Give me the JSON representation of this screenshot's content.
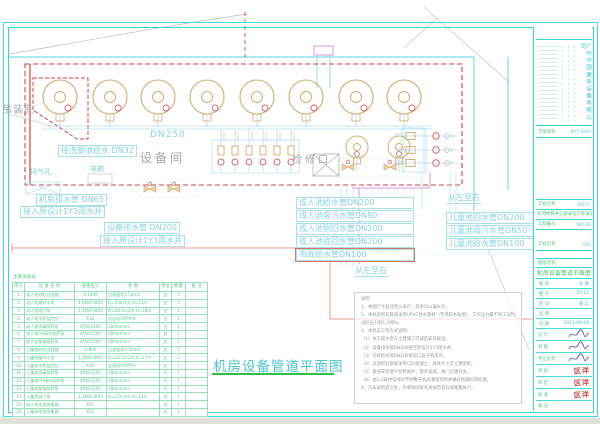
{
  "main_title": "机房设备管道平面图",
  "colors": {
    "frame_cyan": "#2fd6d6",
    "label_cyan": "#86d2e2",
    "table_green": "#5ac88d",
    "tank_tan": "#d4ab6e",
    "boundary_red": "#cc4444",
    "stamp_red": "#c84238",
    "underline_green": "#2ec043",
    "magenta_pipe": "#dd7ad8"
  },
  "plan": {
    "room_label": "设备间",
    "access_label": "检修口",
    "hoist_label": "吊装孔",
    "vent_label": "排气孔",
    "panel_label": "电箱",
    "washfoot_label": "接洗脚池给水 DN32",
    "main_pipe_label": "DN250",
    "direction_labels": [
      "从左至右",
      "从左至右"
    ],
    "drain_labels": [
      "机房排水管 DN65",
      "接入原设计1Y3雨水井",
      "设备排水管 DN200",
      "接入原设计1Y3雨水井"
    ],
    "adult_pipe_labels": [
      "成人池给水管DN200",
      "成人池吸污水管DN80",
      "成人池侧回水管DN200",
      "成人池底回水管DN200",
      "市政给水管DN100"
    ],
    "child_pipe_labels": [
      "儿童池回水管DN200",
      "儿童池吸污水管DN50",
      "儿童池给水管DN100"
    ],
    "tanks_large": {
      "cy": 97,
      "r": 17,
      "xs": [
        60,
        110,
        158,
        207,
        257,
        306,
        356,
        404
      ]
    },
    "tanks_small": {
      "cy": 147,
      "r": 11,
      "xs": [
        357,
        399
      ]
    },
    "manifold_vertical_xs": [
      221,
      235,
      249,
      263,
      277,
      291
    ],
    "manifold_horizontal_ys": [
      136,
      150,
      163
    ]
  },
  "equipment_table": {
    "caption": "主要设备表",
    "headers": [
      "序号",
      "设 备 名 称",
      "规格型号",
      "参  数",
      "单位",
      "数量",
      "备 注"
    ],
    "rows": [
      [
        "1",
        "成人池砂缸过滤器",
        "S-1400",
        "过滤面积1.54m2",
        "台",
        "5",
        ""
      ],
      [
        "2",
        "成人池循环水泵",
        "4.6KW/380V",
        "Q=50m3/h,H=23m",
        "台",
        "5",
        ""
      ],
      [
        "3",
        "成人池吸污泵",
        "2.2KW/380V",
        "Q=28.3m3/h,H=18m",
        "台",
        "1",
        ""
      ],
      [
        "4",
        "成人池水质监控仪",
        "K42",
        "全自动ORP/PH",
        "台",
        "1",
        ""
      ],
      [
        "5",
        "成人池消毒投药泵",
        "45W/220V",
        "280ml/min",
        "台",
        "1",
        ""
      ],
      [
        "6",
        "成人池PH调节投药泵",
        "45W/220V",
        "280ml/min",
        "台",
        "1",
        ""
      ],
      [
        "7",
        "成人池絮凝投药泵",
        "45W/220V",
        "280ml/min",
        "台",
        "1",
        ""
      ],
      [
        "8",
        "儿童池砂缸过滤器",
        "S-800",
        "过滤面积0.50m2",
        "台",
        "2",
        ""
      ],
      [
        "9",
        "儿童池循环水泵",
        "2.2KW/380V",
        "Q=28.5m3/h,H=17m",
        "台",
        "2",
        ""
      ],
      [
        "10",
        "儿童池水质监控仪",
        "K42",
        "全自动ORP/PH",
        "台",
        "1",
        ""
      ],
      [
        "11",
        "儿童池消毒投药泵",
        "45W/220V",
        "280ml/min",
        "台",
        "1",
        ""
      ],
      [
        "12",
        "儿童池PH调节投药泵",
        "45W/220V",
        "280ml/min",
        "台",
        "1",
        ""
      ],
      [
        "13",
        "儿童池絮凝投药泵",
        "45W/220V",
        "280ml/min",
        "台",
        "1",
        ""
      ],
      [
        "14",
        "儿童池吸污泵",
        "2.2KW/380V",
        "Q=15m3/h,H=13m",
        "台",
        "1",
        ""
      ],
      [
        "15",
        "成人池毛发收集器",
        "KT1",
        "",
        "台",
        "1",
        ""
      ],
      [
        "16",
        "儿童池毛发收集器",
        "KT2",
        "",
        "台",
        "1",
        ""
      ]
    ]
  },
  "notes": {
    "lines": [
      "说明",
      "1、本图尺寸标注皆以米计，其余均以毫米计。",
      "2、本机房所有管道采用UPVC给水管材（专用胶水粘接），工作压力最不利工况时，",
      "      试验压力取1.2MPa。",
      "3、本机房工作方式说明：",
      "   （1）本工程水泵在土建施工完成后安装就位。",
      "   （2）设备排水管DN200接至原设计1Y3雨水井。",
      "   （3）市政给水管DN100接驳口设于机房内。",
      "   （4）过滤砂缸基础采用C20混凝土，具体大小见土建图纸。",
      "   （5）管道安装便于检修维护，整齐美观，阀门方便开关。",
      "   （6）由1.2级材电线均不明敷于机房潮湿场所并做好防腐防锈处理。",
      "4、凡未说明者之处，均参照国家有关规范及标准图集执行。"
    ]
  },
  "titleblock": {
    "company": "广州中国康体设备有限公司",
    "cert": {
      "label": "节能审批",
      "value": "407-1049"
    },
    "project": {
      "label": "工程名称",
      "value": "PA127"
    },
    "project_name": "天河体育中心游泳馆户外泳池工程",
    "project_no": {
      "label": "工程编号",
      "value": "NST30"
    },
    "lead": {
      "label": "工程负责",
      "value": "02K"
    },
    "sheet": {
      "label": "图纸名称",
      "value": ""
    },
    "sheet_name": "机房设备管道平面图",
    "info_rows": [
      [
        "图 别",
        "水 施"
      ],
      [
        "图 号",
        "ZY-12"
      ],
      [
        "阶 段",
        "施 工"
      ],
      [
        "比 例",
        ""
      ],
      [
        "日 期",
        "2013-09-06"
      ]
    ],
    "sign_rows": [
      {
        "label": "设 计",
        "mark": "sig"
      },
      {
        "label": "制 图",
        "mark": "sig"
      },
      {
        "label": "专业负责",
        "mark": "sig"
      },
      {
        "label": "审 核",
        "mark": "stamp"
      },
      {
        "label": "审 定",
        "mark": "stamp"
      },
      {
        "label": "批 准",
        "mark": "stamp"
      }
    ],
    "stamp_text": "区洋",
    "note_row": {
      "label": "备 注",
      "value": ""
    }
  }
}
